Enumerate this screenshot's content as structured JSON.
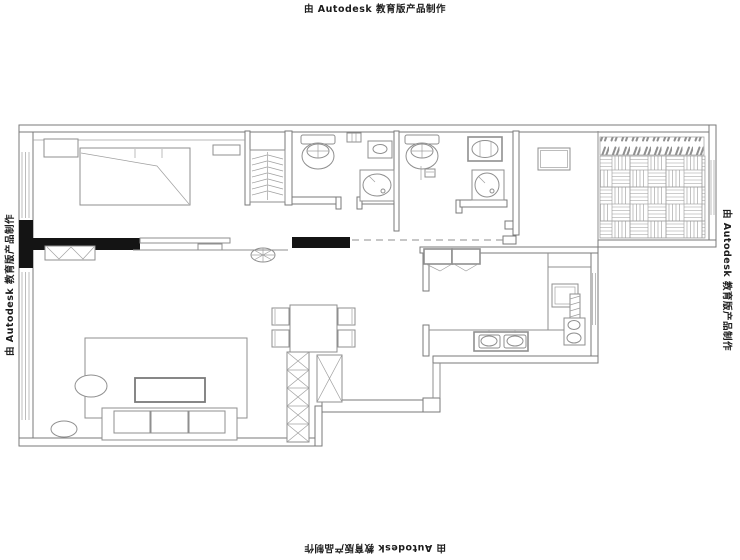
{
  "watermarks": {
    "text": "由 Autodesk 教育版产品制作",
    "positions": [
      "top",
      "left",
      "right",
      "bottom"
    ]
  },
  "colors": {
    "background": "#ffffff",
    "drawing_line": "#8f8f8f",
    "wall_outline": "#7a7a7a",
    "solid_wall_fill": "#141414",
    "watermark_text": "#1c1c1c"
  },
  "plan": {
    "type": "floor-plan",
    "symbols": [
      "bed",
      "nightstand",
      "wardrobe-hanger-rail",
      "toilet",
      "wall-hung-basin",
      "corner-sink",
      "washing-machine",
      "refrigerator",
      "two-burner-stove",
      "kitchen-sink",
      "shoe-cabinet",
      "dining-table",
      "dining-chair",
      "storage-column-x-hatch",
      "sofa-three-seat",
      "coffee-table",
      "area-rug",
      "oval-side-table",
      "oval-stool",
      "plant-fan-symbol",
      "tv-cabinet",
      "sliding-door",
      "window-triple-line",
      "load-bearing-wall",
      "balcony-basket-weave-floor",
      "louver-screen",
      "opening-dashed-line"
    ]
  }
}
